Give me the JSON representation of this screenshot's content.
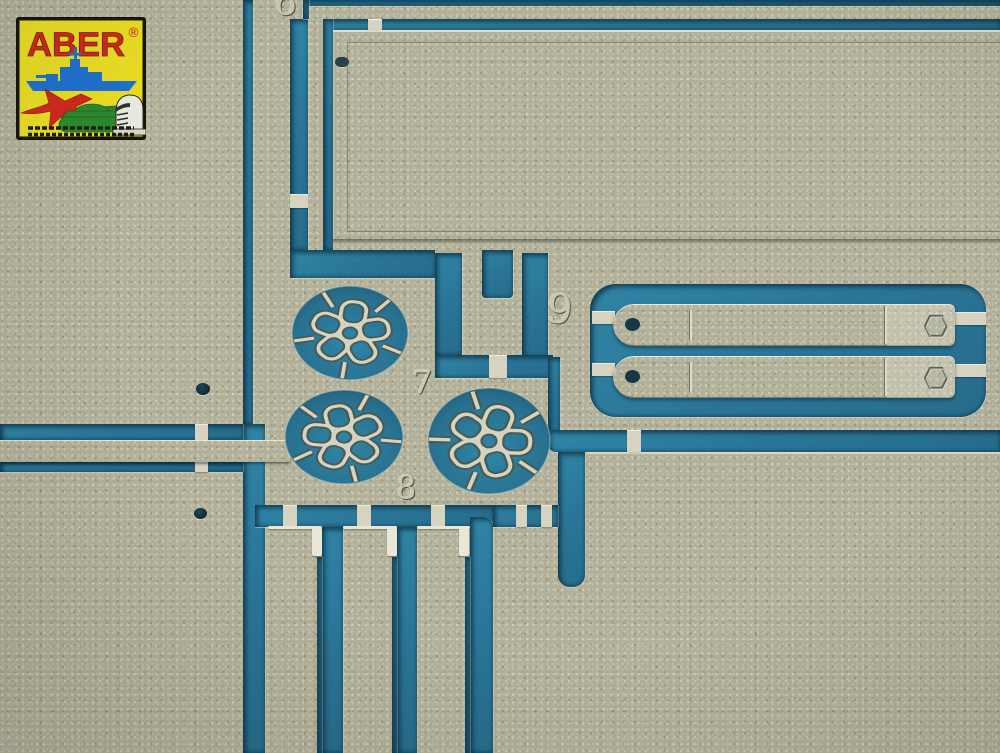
{
  "scene": {
    "description": "Macro photograph of an ABER photo-etched metal parts fret on a teal backing sheet",
    "colors": {
      "backing_blue": "#2a7496",
      "metal_tan": "#b2b098",
      "edge_highlight": "#e9e7d7",
      "etch_shadow": "#4c564d"
    }
  },
  "logo": {
    "brand": "ABER",
    "registered_mark": "®",
    "background": "#ecdf25",
    "brand_color": "#cd2a1b",
    "icons": [
      "battleship-icon",
      "jet-icon",
      "tank-icon",
      "knight-icon"
    ]
  },
  "part_labels": {
    "p6": "6",
    "p7": "7",
    "p8": "8",
    "p9": "9"
  }
}
